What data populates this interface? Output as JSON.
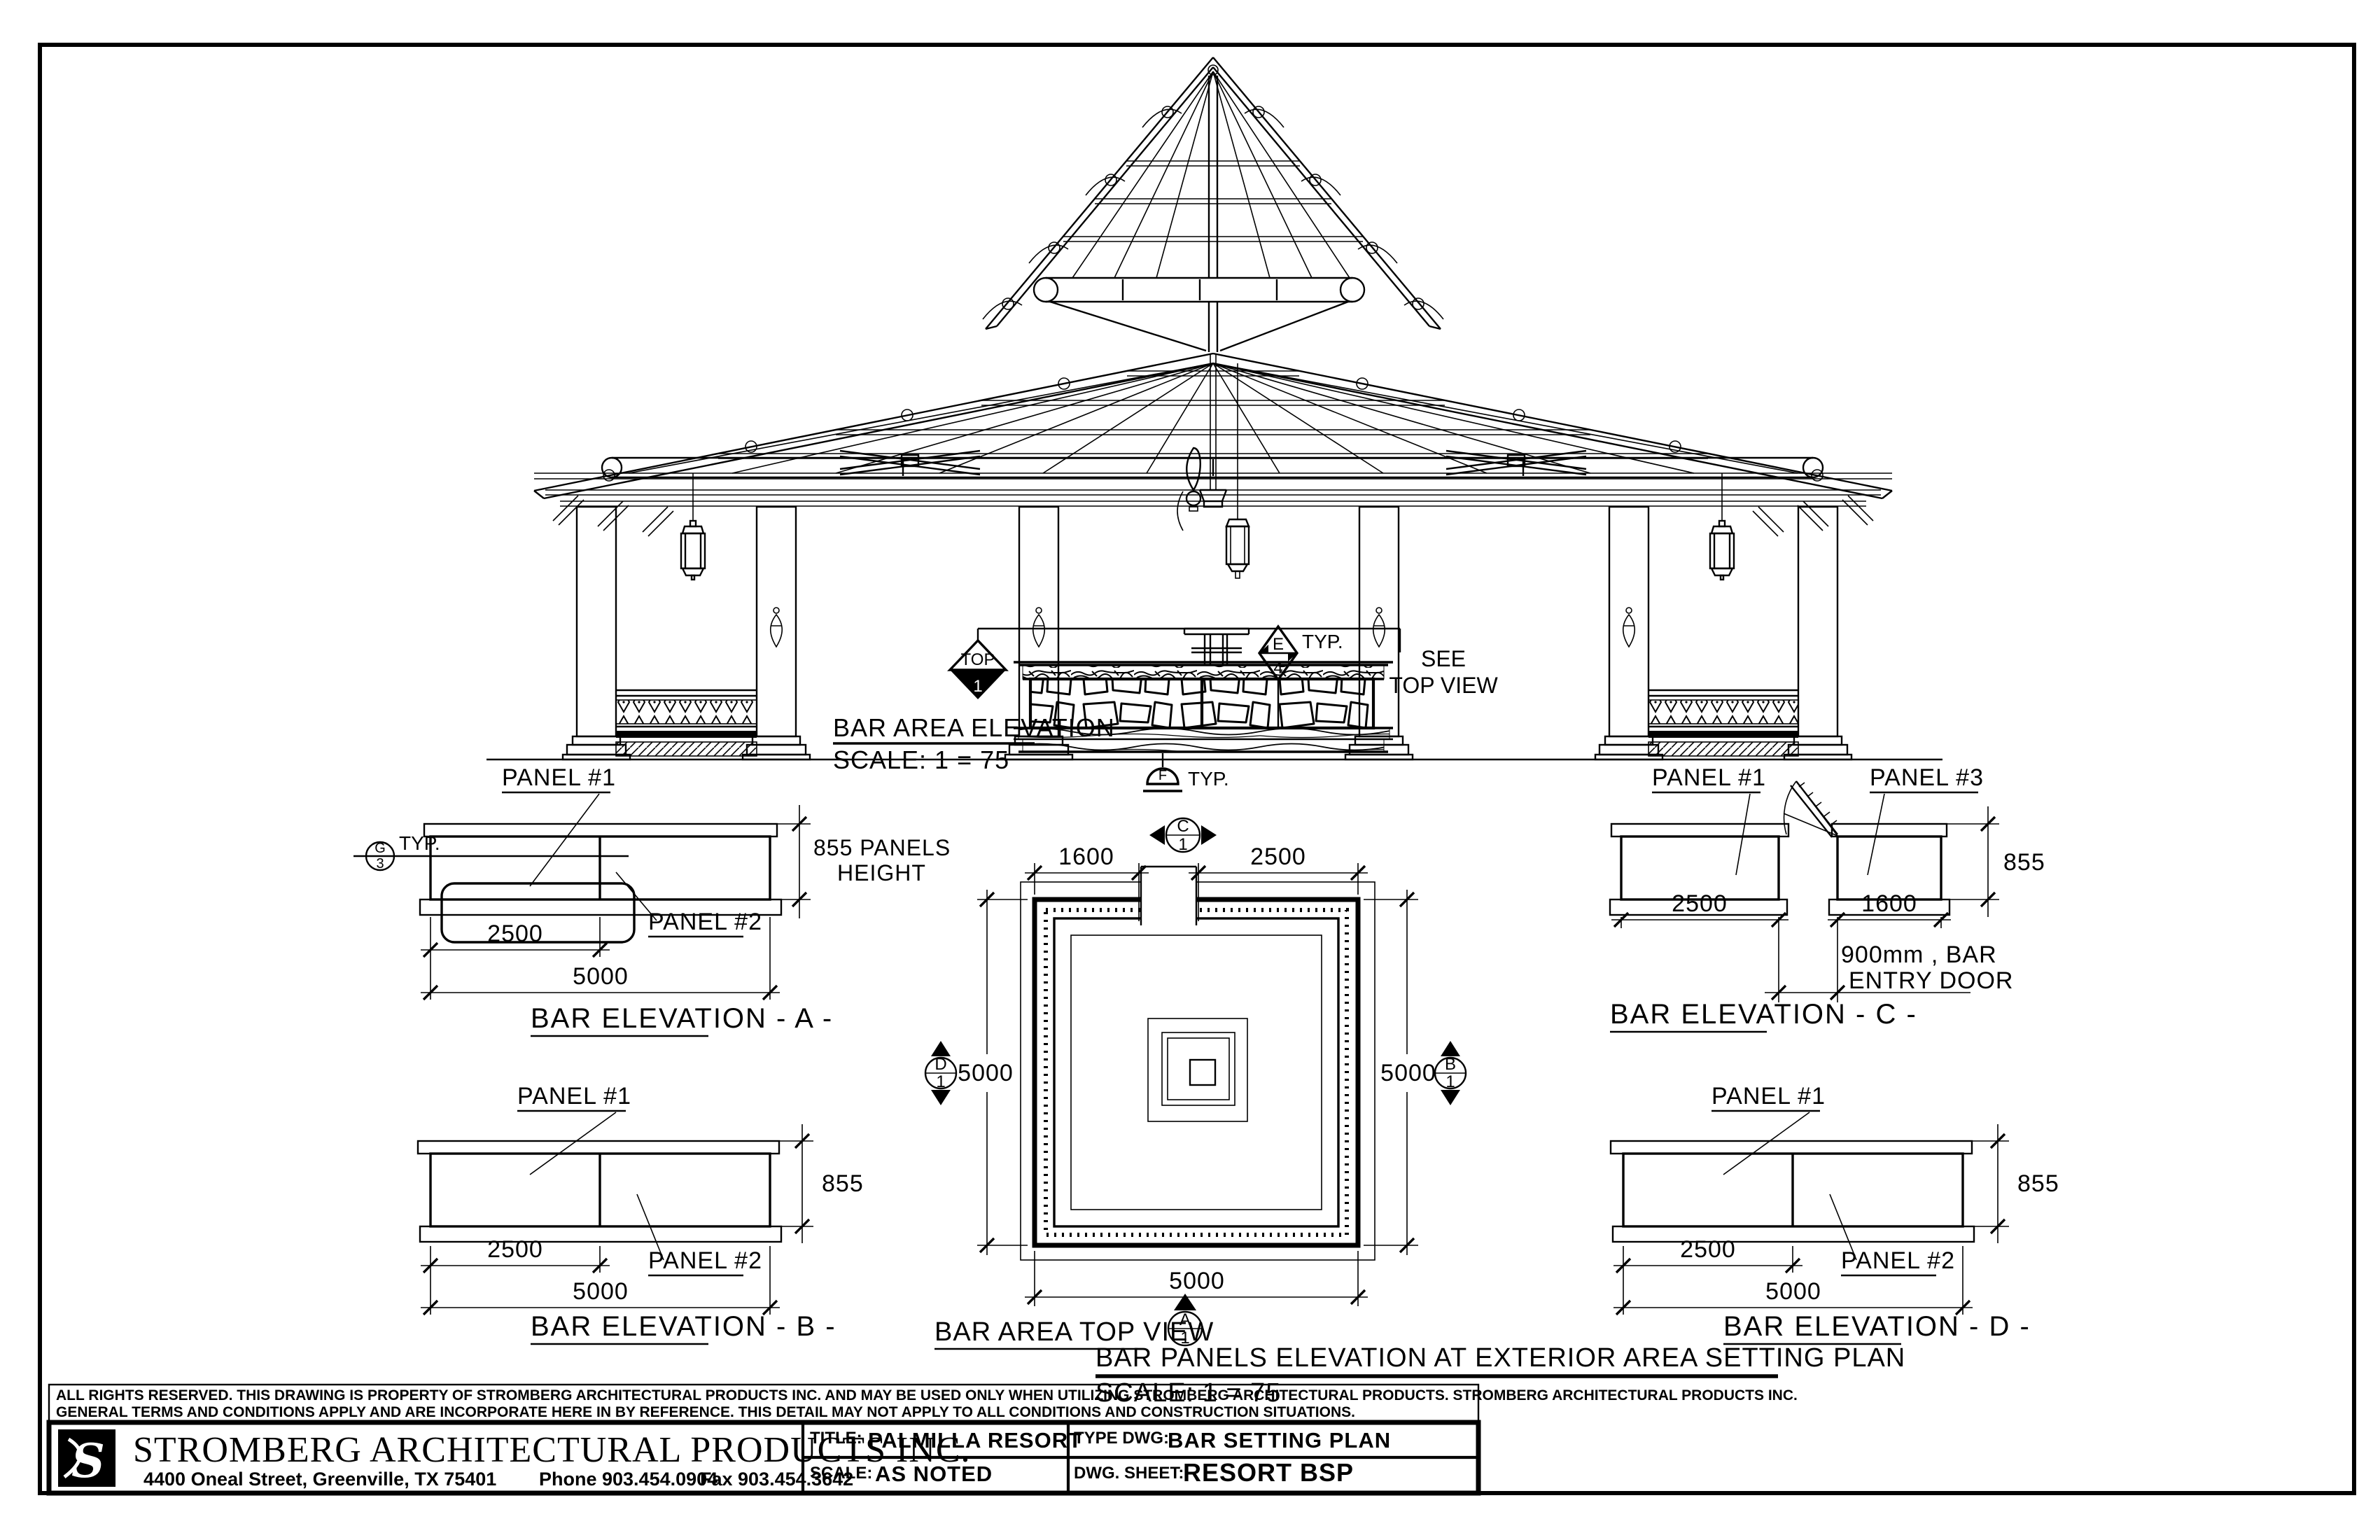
{
  "main_elevation": {
    "title": "BAR AREA ELEVATION",
    "scale": "SCALE: 1 = 75",
    "marker_top": {
      "label": "TOP",
      "number": "1"
    },
    "marker_e": {
      "letter": "E",
      "number": "4",
      "typ": "TYP."
    },
    "marker_f": {
      "letter": "F",
      "typ": "TYP."
    },
    "see_top_view_line1": "SEE",
    "see_top_view_line2": "TOP VIEW"
  },
  "elevation_a": {
    "title": "BAR ELEVATION - A -",
    "panel1_label": "PANEL #1",
    "panel2_label": "PANEL #2",
    "height_note_line1": "855 PANELS",
    "height_note_line2": "HEIGHT",
    "dim_half": "2500",
    "dim_full": "5000",
    "marker_letter": "G",
    "marker_number": "3",
    "typ": "TYP."
  },
  "elevation_b": {
    "title": "BAR ELEVATION - B -",
    "panel1_label": "PANEL #1",
    "panel2_label": "PANEL #2",
    "dim_height": "855",
    "dim_half": "2500",
    "dim_full": "5000"
  },
  "elevation_c": {
    "title": "BAR ELEVATION - C -",
    "panel1_label": "PANEL #1",
    "panel3_label": "PANEL #3",
    "dim_height": "855",
    "dim_panel1": "2500",
    "dim_panel3": "1600",
    "door_note_line1": "900mm , BAR",
    "door_note_line2": "ENTRY DOOR"
  },
  "elevation_d": {
    "title": "BAR ELEVATION - D -",
    "panel1_label": "PANEL #1",
    "panel2_label": "PANEL #2",
    "dim_height": "855",
    "dim_half": "2500",
    "dim_full": "5000"
  },
  "top_view": {
    "title": "BAR AREA TOP VIEW",
    "dim_top_left": "1600",
    "dim_top_right": "2500",
    "dim_left": "5000",
    "dim_right": "5000",
    "dim_bottom": "5000",
    "marker_top": {
      "letter": "C",
      "number": "1"
    },
    "marker_bottom": {
      "letter": "A",
      "number": "1"
    },
    "marker_left": {
      "letter": "D",
      "number": "1"
    },
    "marker_right": {
      "letter": "B",
      "number": "1"
    }
  },
  "caption": {
    "line1": "BAR PANELS ELEVATION AT EXTERIOR AREA SETTING PLAN",
    "scale": "SCALE: 1 = 75"
  },
  "title_block": {
    "disclaimer_line1": "ALL RIGHTS RESERVED. THIS DRAWING IS PROPERTY OF STROMBERG ARCHITECTURAL PRODUCTS INC. AND MAY BE USED ONLY WHEN UTILIZING STROMBERG ARCHITECTURAL PRODUCTS.  STROMBERG ARCHITECTURAL PRODUCTS INC.",
    "disclaimer_line2": "GENERAL TERMS AND CONDITIONS APPLY AND ARE INCORPORATE HERE IN BY REFERENCE.  THIS DETAIL MAY NOT APPLY TO ALL CONDITIONS AND CONSTRUCTION SITUATIONS.",
    "company": "STROMBERG ARCHITECTURAL PRODUCTS INC.",
    "logo_letter": "S",
    "address": "4400 Oneal Street, Greenville, TX  75401",
    "phone": "Phone 903.454.0904",
    "fax": "Fax 903.454.3642",
    "title_label": "TITLE:",
    "title_value": "PALMILLA RESORT",
    "type_label": "TYPE DWG:",
    "type_value": "BAR SETTING PLAN",
    "scale_label": "SCALE:",
    "scale_value": "AS NOTED",
    "sheet_label": "DWG. SHEET:",
    "sheet_value": "RESORT BSP"
  }
}
